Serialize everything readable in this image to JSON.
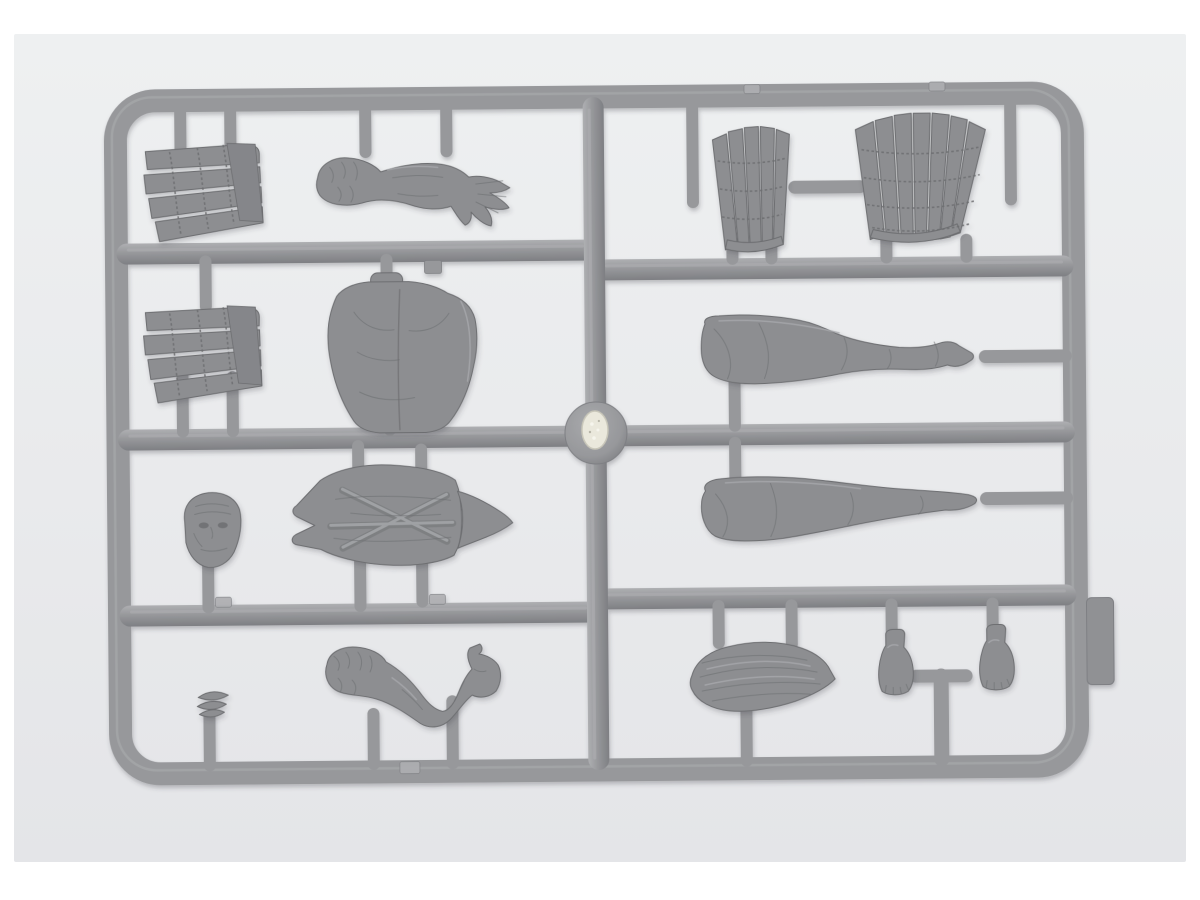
{
  "scene": {
    "type": "photograph",
    "subject": "Gray plastic injection-molded model-kit sprue (runner) holding unassembled, unpainted figure parts, photographed on a light neutral background",
    "colors": {
      "page": "#ffffff",
      "photo-bg-light": "#eef0f1",
      "photo-bg": "#e9eaec",
      "photo-bg-dark": "#e4e5e8",
      "sprue": "#97989b",
      "sprue-light": "#aeafb2",
      "sprue-dark": "#7e7f83",
      "sprue-dim": "#909194",
      "part": "#8d8e91",
      "part-light": "#a8a9ac",
      "part-dim": "#85868a",
      "part-dark": "#6d6e71",
      "gate-mark": "#eae8dc",
      "gate-mark-edge": "#c8c6b9",
      "shadow": "#3c3e42"
    }
  },
  "sprue": {
    "frame": "Rounded rectangular outer runner frame",
    "runners": [
      "upper-left horizontal runner",
      "full-width middle runner",
      "lower-left horizontal runner",
      "upper-right horizontal runner",
      "lower-right horizontal runner",
      "central vertical runner"
    ],
    "injection_gate": "Central round injection-gate boss with rough silver mold mark",
    "molding_tab": "Rectangular molding tab on outer right edge"
  },
  "parts": [
    {
      "id": "lamellar-armor-flap-a",
      "label": "Lamellar armor flap (upper left)",
      "bbox": [
        148,
        136,
        120,
        100
      ]
    },
    {
      "id": "clawed-arm",
      "label": "Outstretched furry arm with clawed hand",
      "bbox": [
        315,
        152,
        200,
        75
      ]
    },
    {
      "id": "lamellar-armor-flap-b",
      "label": "Lamellar armor flap (middle left)",
      "bbox": [
        146,
        298,
        120,
        85
      ]
    },
    {
      "id": "torso-back",
      "label": "Torso back half with neck stub",
      "bbox": [
        326,
        268,
        152,
        162
      ]
    },
    {
      "id": "lamellar-skirt-small",
      "label": "Small lamellar armor skirt (upper right)",
      "bbox": [
        713,
        128,
        80,
        126
      ]
    },
    {
      "id": "lamellar-skirt-large",
      "label": "Large lamellar armor skirt (upper right)",
      "bbox": [
        856,
        114,
        134,
        138
      ]
    },
    {
      "id": "leg-upper",
      "label": "Leg with open thigh cut (middle right)",
      "bbox": [
        700,
        315,
        286,
        72
      ]
    },
    {
      "id": "leg-lower",
      "label": "Second leg (lower right)",
      "bbox": [
        699,
        477,
        282,
        68
      ]
    },
    {
      "id": "head",
      "label": "Head with furrowed brow",
      "bbox": [
        182,
        488,
        60,
        76
      ]
    },
    {
      "id": "armored-torso-front",
      "label": "Armored torso front with fishtail collar and side spike",
      "bbox": [
        292,
        461,
        222,
        105
      ]
    },
    {
      "id": "hair-knot",
      "label": "Small ribbed hair-knot part",
      "bbox": [
        193,
        683,
        34,
        35
      ]
    },
    {
      "id": "bent-arm",
      "label": "Bent furry arm with open hand, thumb up",
      "bbox": [
        320,
        641,
        180,
        90
      ]
    },
    {
      "id": "hair-piece",
      "label": "Flowing pointed hair piece",
      "bbox": [
        686,
        641,
        147,
        74
      ]
    },
    {
      "id": "foot-a",
      "label": "Bare foot with toes (left of pair)",
      "bbox": [
        876,
        630,
        36,
        68
      ]
    },
    {
      "id": "foot-b",
      "label": "Bare foot with toes (right of pair)",
      "bbox": [
        977,
        626,
        36,
        68
      ]
    }
  ]
}
